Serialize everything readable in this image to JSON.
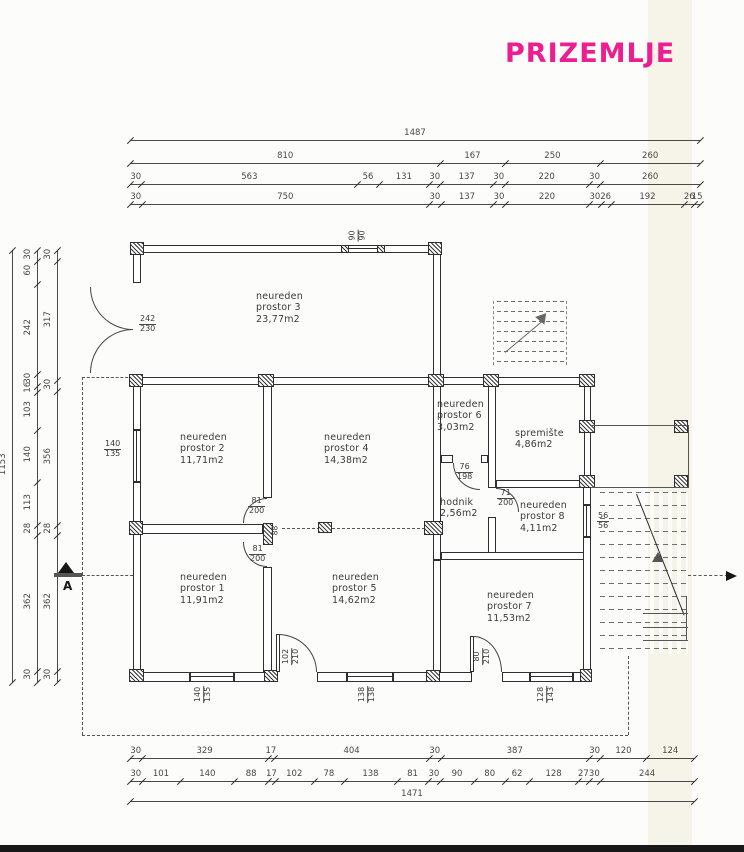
{
  "title": "PRIZEMLJE",
  "accent_color": "#ed1f90",
  "rooms": [
    "neureden\nprostor 3\n23,77m2",
    "neureden\nprostor 2\n11,71m2",
    "neureden\nprostor 4\n14,38m2",
    "neureden\nprostor 6\n3,03m2",
    "spremište\n4,86m2",
    "hodnik\n2,56m2",
    "neureden\nprostor 8\n4,11m2",
    "neureden\nprostor 1\n11,91m2",
    "neureden\nprostor 5\n14,62m2",
    "neureden\nprostor 7\n11,53m2"
  ],
  "fracs": [
    {
      "t": "242",
      "b": "230"
    },
    {
      "t": "140",
      "b": "135"
    },
    {
      "t": "90",
      "b": "90"
    },
    {
      "t": "81",
      "b": "200"
    },
    {
      "t": "81",
      "b": "200"
    },
    {
      "t": "76",
      "b": "198"
    },
    {
      "t": "71",
      "b": "200"
    },
    {
      "t": "56",
      "b": "56"
    },
    {
      "t": "102",
      "b": "210"
    },
    {
      "t": "80",
      "b": "210"
    },
    {
      "t": "140",
      "b": "135"
    },
    {
      "t": "138",
      "b": "138"
    },
    {
      "t": "128",
      "b": "143"
    }
  ],
  "pier_label": "88",
  "section_marker": "A",
  "dims": {
    "top": [
      [
        "1487"
      ],
      [
        "810",
        "167",
        "250",
        "260"
      ],
      [
        "30",
        "563",
        "56",
        "131",
        "30",
        "137",
        "30",
        "220",
        "30",
        "260"
      ],
      [
        "30",
        "750",
        "30",
        "137",
        "30",
        "220",
        "30",
        "26",
        "192",
        "26",
        "15"
      ]
    ],
    "left": [
      [
        "1153"
      ],
      [
        "30",
        "60",
        "242",
        "30",
        "16",
        "103",
        "140",
        "113",
        "28",
        "362",
        "30"
      ],
      [
        "30",
        "317",
        "30",
        "356",
        "28",
        "362",
        "30"
      ]
    ],
    "bottom": [
      [
        "30",
        "329",
        "17",
        "404",
        "30",
        "387",
        "30",
        "120",
        "124"
      ],
      [
        "30",
        "101",
        "140",
        "88",
        "17",
        "102",
        "78",
        "138",
        "81",
        "30",
        "90",
        "80",
        "62",
        "128",
        "27",
        "30",
        "244"
      ],
      [
        "1471"
      ]
    ]
  }
}
